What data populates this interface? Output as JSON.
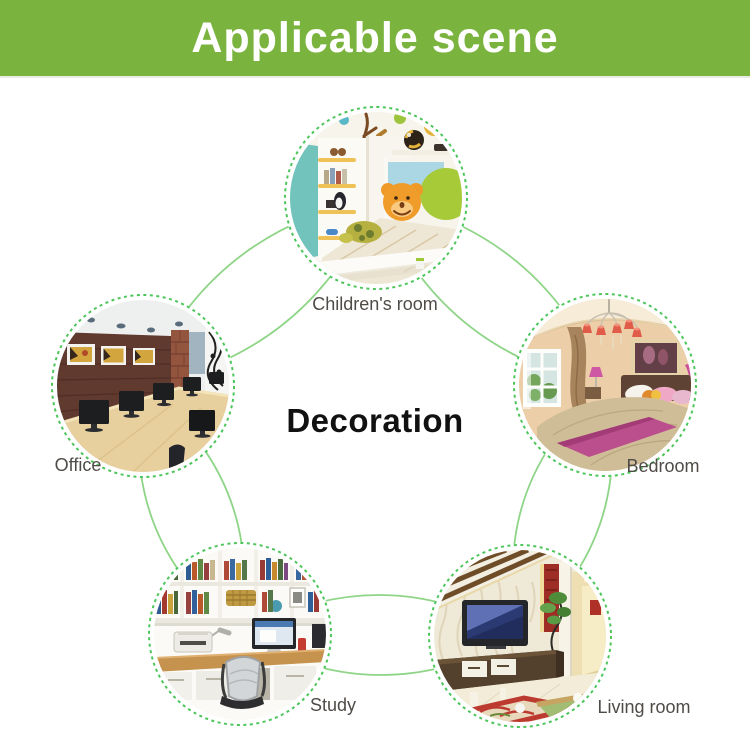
{
  "header": {
    "title": "Applicable scene"
  },
  "diagram": {
    "center_label": "Decoration",
    "scenes": [
      {
        "label": "Children's room"
      },
      {
        "label": "Office"
      },
      {
        "label": "Bedroom"
      },
      {
        "label": "Study"
      },
      {
        "label": "Living room"
      }
    ]
  },
  "colors": {
    "banner_bg": "#7ab43e",
    "banner_text": "#ffffff",
    "connector_arc": "#8fd588",
    "dashed_ring": "#4cc65a",
    "label_text": "#4f4b47",
    "center_text": "#111111"
  }
}
